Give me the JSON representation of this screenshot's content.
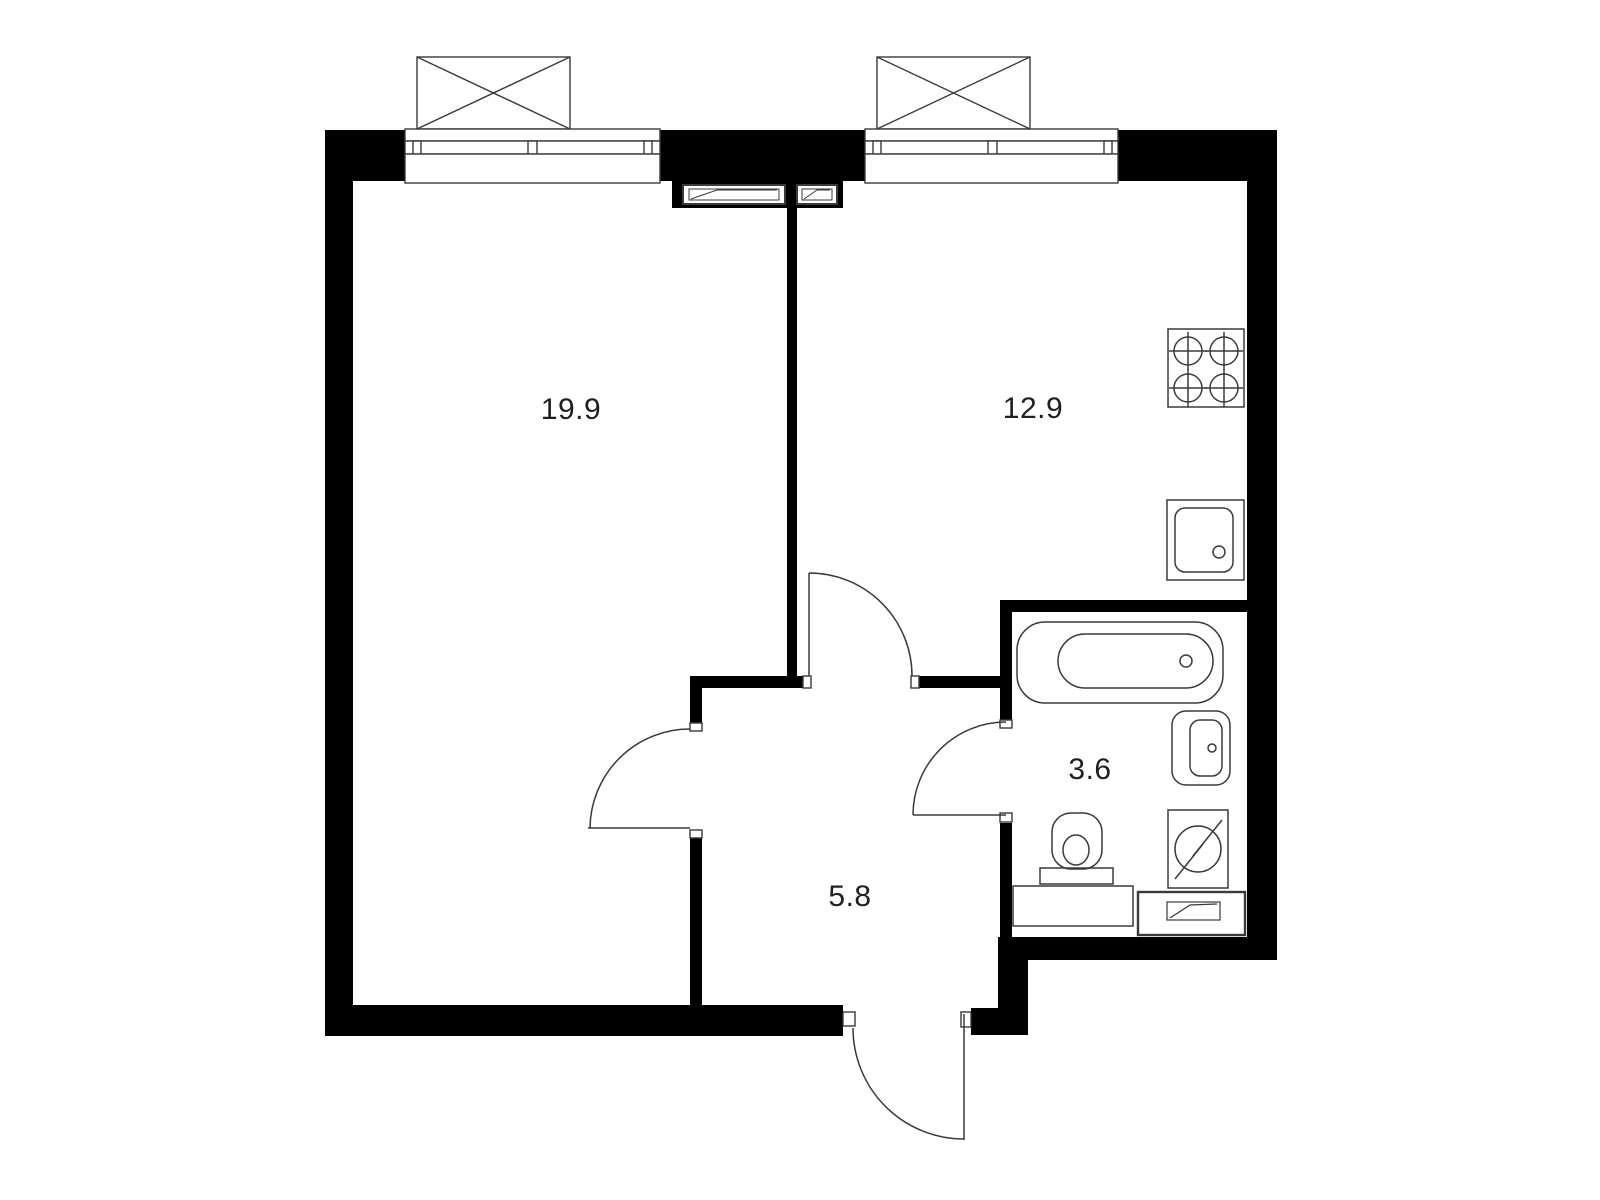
{
  "plan": {
    "type": "apartment-floor-plan",
    "rooms": [
      {
        "name": "living-room",
        "area": "19.9"
      },
      {
        "name": "kitchen",
        "area": "12.9"
      },
      {
        "name": "bathroom",
        "area": "3.6"
      },
      {
        "name": "hallway",
        "area": "5.8"
      }
    ],
    "fixtures": [
      "balcony-window",
      "balcony-window",
      "vent-duct",
      "vent-duct",
      "stove-4-burners",
      "kitchen-sink",
      "bathtub",
      "washbasin",
      "toilet",
      "washing-machine",
      "vent-box",
      "bathroom-counter",
      "living-room-door",
      "kitchen-door",
      "bathroom-door",
      "entrance-door"
    ],
    "colors": {
      "wall": "#000000",
      "line": "#3a3a3a",
      "bg": "#ffffff",
      "text": "#1f1f1f"
    }
  }
}
